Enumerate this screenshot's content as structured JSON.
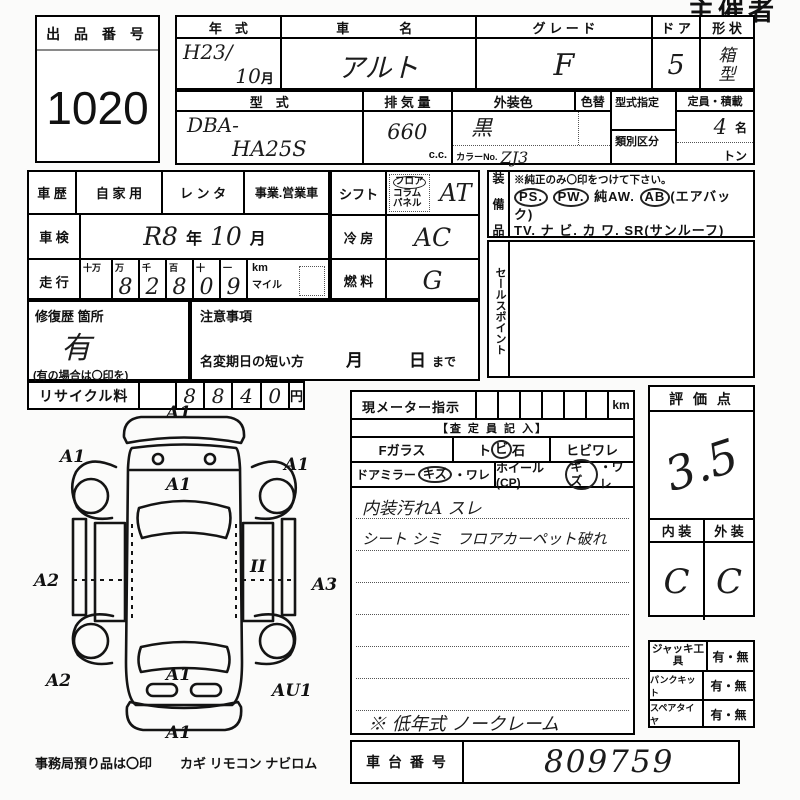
{
  "page": {
    "use_label": "主催者用"
  },
  "auction": {
    "label": "出 品 番 号",
    "number": "1020"
  },
  "vehicle": {
    "year_label": "年　式",
    "year_line1": "H23/",
    "year_line2": "10",
    "month_unit": "月",
    "name_label": "車　　名",
    "name_value": "アルト",
    "grade_label": "グ レ ー ド",
    "grade_value": "F",
    "door_label": "ド ア",
    "door_value": "5",
    "shape_label": "形 状",
    "shape_value": "箱型",
    "model_label": "型　式",
    "model_line1": "DBA-",
    "model_line2": "HA25S",
    "disp_label": "排 気 量",
    "disp_value": "660",
    "disp_unit": "c.c.",
    "color_label": "外装色",
    "color_value": "黒",
    "recolor_label": "色替",
    "colorno_label": "カラーNo.",
    "colorno_value": "ZJ3",
    "spec_label": "型式指定",
    "class_label": "類別区分",
    "capacity_label": "定員・積載",
    "capacity_value": "4",
    "capacity_unit": "名",
    "ton_unit": "トン"
  },
  "history": {
    "label": "車 歴",
    "private": "自 家 用",
    "rental": "レ ン タ",
    "business": "事業.営業車",
    "inspection_label": "車 検",
    "inspection_era": "R8",
    "inspection_year_unit": "年",
    "inspection_month": "10",
    "inspection_month_unit": "月",
    "mileage_label": "走 行",
    "digit_labels": [
      "十万",
      "万",
      "千",
      "百",
      "十",
      "一"
    ],
    "digits": [
      "",
      "8",
      "2",
      "8",
      "0",
      "9"
    ],
    "km_label": "km",
    "mile_label": "マイル"
  },
  "repair": {
    "label": "修復歴 箇所",
    "value": "有",
    "note": "(有の場合は〇印を)"
  },
  "caution": {
    "label": "注意事項",
    "deadline_label": "名変期日の短い方",
    "month_unit": "月",
    "day_unit": "日",
    "made_label": "まで"
  },
  "recycle": {
    "label": "リサイクル料",
    "digits": [
      "8",
      "8",
      "4",
      "0"
    ],
    "unit": "円"
  },
  "drivetrain": {
    "shift_label": "シフト",
    "floor": "フロア",
    "column": "コラム",
    "panel": "パネル",
    "shift_value": "AT",
    "ac_label": "冷 房",
    "ac_value": "AC",
    "fuel_label": "燃 料",
    "fuel_value": "G"
  },
  "equipment": {
    "label": "装 備 品",
    "note": "※純正のみ〇印をつけて下さい。",
    "ps": "PS.",
    "pw": "PW.",
    "aw": "純AW.",
    "ab": "AB",
    "airbag": "(エアバック)",
    "tv": "TV.",
    "navi": "ナ ビ.",
    "kawa": "カ ワ.",
    "sr": "SR(サンルーフ)",
    "abs": "ABS",
    "dot": "・",
    "warranty": "新車保証書←(注) 後日送りのみ"
  },
  "sales_point": {
    "label": "セールスポイント"
  },
  "meter": {
    "label": "現メーター指示",
    "km_label": "km",
    "assessor_label": "【査 定 員 記 入】",
    "fglass": "Fガラス",
    "tobi_pre": "ト",
    "tobi_circle": "ビ",
    "tobi_post": "石",
    "hibiware": "ヒビワレ",
    "mirror": "ドアミラー",
    "mirror_kizu": "キズ",
    "mirror_ware": "・ワレ",
    "wheel": "ホイール(CP)",
    "wheel_kizu": "キズ",
    "wheel_ware": "・ワレ",
    "note1": "内装汚れA スレ",
    "note2": "シート シミ　フロアカーペット破れ",
    "note3": "※ 低年式 ノークレーム"
  },
  "rating": {
    "label": "評 価 点",
    "score": "3.5",
    "interior_label": "内 装",
    "exterior_label": "外 装",
    "interior_value": "C",
    "exterior_value": "C"
  },
  "tools": {
    "rows": [
      {
        "label": "ジャッキ工具",
        "value": "有・無"
      },
      {
        "label": "パンクキット",
        "value": "有・無"
      },
      {
        "label": "スペアタイヤ",
        "value": "有・無"
      }
    ]
  },
  "chassis": {
    "label": "車 台 番 号",
    "value": "809759"
  },
  "footer": {
    "text": "事務局預り品は〇印",
    "items": "カギ  リモコン  ナビロム"
  },
  "diagram": {
    "annotations": [
      {
        "x": 138,
        "y": 14,
        "label": "A1"
      },
      {
        "x": 32,
        "y": 58,
        "label": "A1"
      },
      {
        "x": 256,
        "y": 66,
        "label": "A1"
      },
      {
        "x": 138,
        "y": 86,
        "label": "A1"
      },
      {
        "x": 6,
        "y": 182,
        "label": "A2"
      },
      {
        "x": 284,
        "y": 186,
        "label": "A3"
      },
      {
        "x": 18,
        "y": 282,
        "label": "A2"
      },
      {
        "x": 138,
        "y": 276,
        "label": "A1"
      },
      {
        "x": 244,
        "y": 292,
        "label": "AU1"
      },
      {
        "x": 138,
        "y": 334,
        "label": "A1"
      },
      {
        "x": 222,
        "y": 168,
        "label": "II"
      }
    ]
  }
}
